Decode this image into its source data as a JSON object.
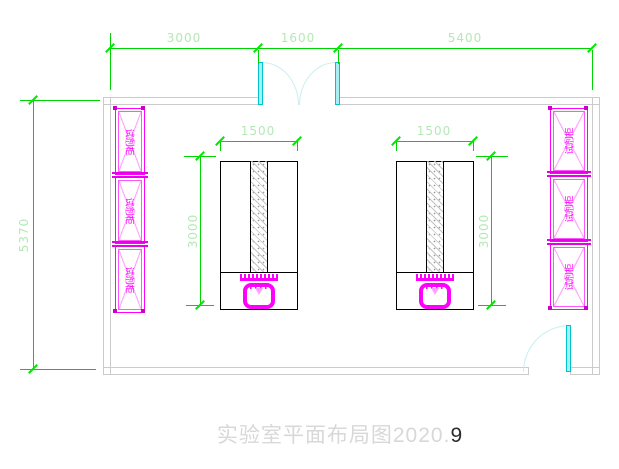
{
  "title": {
    "text": "实验室平面布局图2020.",
    "suffix": "9"
  },
  "dims": {
    "top": [
      "3000",
      "1600",
      "5400"
    ],
    "left_total": "5370",
    "left_bench": {
      "width": "1500",
      "depth": "3000"
    },
    "right_bench": {
      "width": "1500",
      "depth": "3000"
    }
  },
  "cabinets": {
    "left": [
      "试剂柜",
      "试剂柜",
      "试剂柜"
    ],
    "right": [
      "试剂柜",
      "试剂柜",
      "试剂柜"
    ]
  },
  "colors": {
    "dimension_line": "#00d400",
    "dimension_tick": "#00e800",
    "dimension_text": "#b5e8b5",
    "wall_gray": "#cbcbcb",
    "bench_outline": "#000000",
    "cabinet_magenta": "#ff00ff",
    "door_leaf_cyan": "#a8eef2",
    "door_arc_cyan": "#c9eef0",
    "title_gray": "#d8d8d8",
    "title_dark": "#2b2b2b"
  }
}
